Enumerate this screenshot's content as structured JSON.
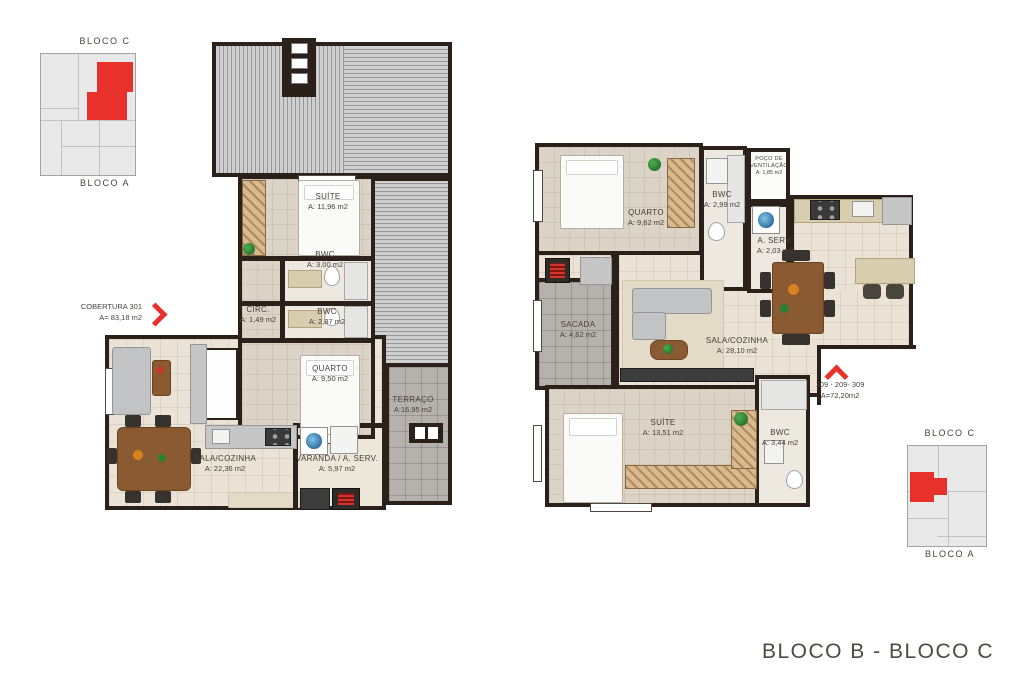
{
  "sheet": {
    "title": "BLOCO B - BLOCO C"
  },
  "keyplan_top": {
    "bloco_c": "BLOCO C",
    "bloco_a": "BLOCO A"
  },
  "keyplan_bottom": {
    "bloco_c": "BLOCO C",
    "bloco_a": "BLOCO A"
  },
  "plan_left": {
    "unit_label": "COBERTURA 301",
    "unit_area": "A= 83,18 m2",
    "rooms": {
      "suite": {
        "name": "SUÍTE",
        "area": "A: 11,96 m2"
      },
      "bwc1": {
        "name": "BWC",
        "area": "A: 3,00 m2"
      },
      "circ": {
        "name": "CIRC.",
        "area": "A: 1,49 m2"
      },
      "bwc2": {
        "name": "BWC",
        "area": "A: 2,87 m2"
      },
      "quarto": {
        "name": "QUARTO",
        "area": "A: 9,50 m2"
      },
      "terraco": {
        "name": "TERRAÇO",
        "area": "A:16,95 m2"
      },
      "sala": {
        "name": "SALA/COZINHA",
        "area": "A: 22,36 m2"
      },
      "varanda": {
        "name": "VARANDA / A. SERV.",
        "area": "A: 5,97 m2"
      }
    }
  },
  "plan_right": {
    "unit_label": "109 - 209- 309",
    "unit_area": "A=72,20m2",
    "rooms": {
      "quarto": {
        "name": "QUARTO",
        "area": "A: 9,62 m2"
      },
      "bwc1": {
        "name": "BWC",
        "area": "A: 2,99 m2"
      },
      "poco": {
        "name": "POÇO DE VENTILAÇÃO",
        "area": "A: 1,85 m2"
      },
      "aserv": {
        "name": "A. SERV.",
        "area": "A: 2,03 m2"
      },
      "sacada": {
        "name": "SACADA",
        "area": "A: 4,62 m2"
      },
      "sala": {
        "name": "SALA/COZINHA",
        "area": "A: 28,10 m2"
      },
      "suite": {
        "name": "SUÍTE",
        "area": "A: 13,51 m2"
      },
      "bwc2": {
        "name": "BWC",
        "area": "A: 3,44 m2"
      }
    }
  },
  "colors": {
    "accent_red": "#E8312B",
    "wall": "#2B211A"
  }
}
